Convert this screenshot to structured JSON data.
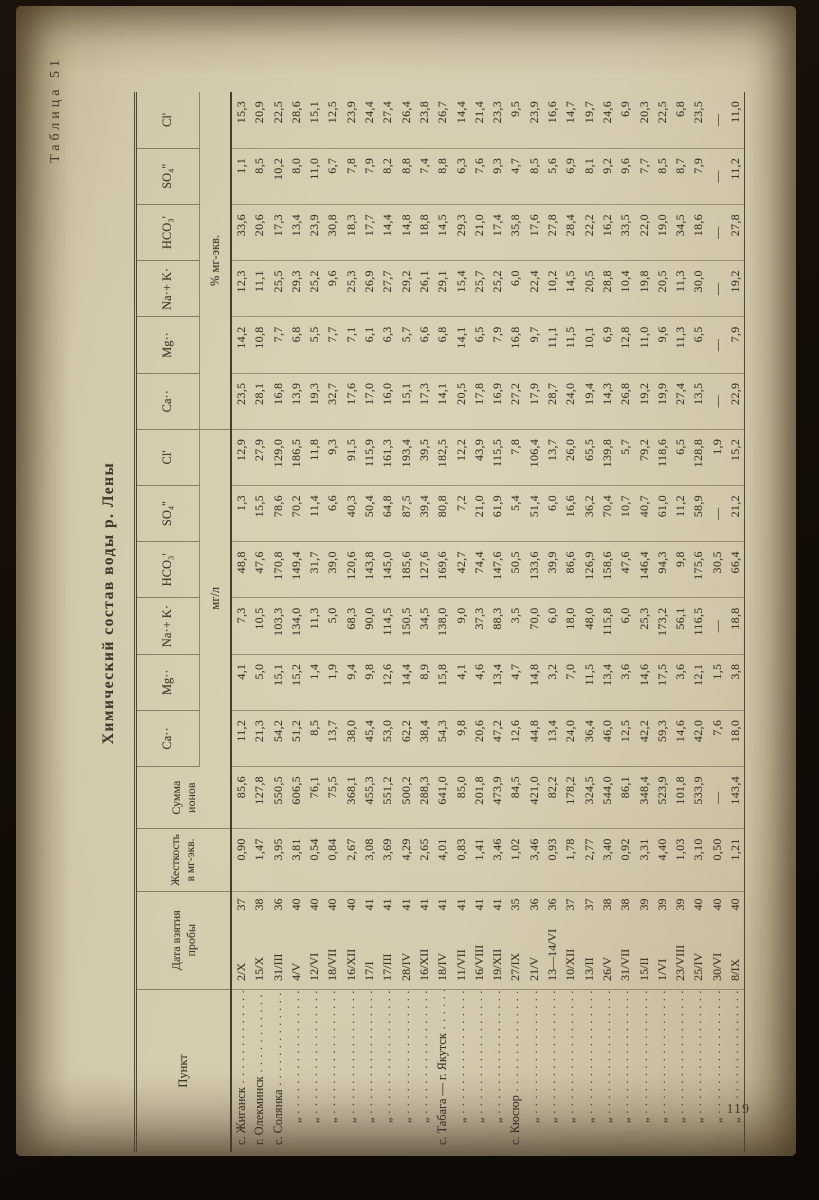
{
  "page": {
    "number": "119"
  },
  "titles": {
    "table_label": "Таблица 51",
    "main_title": "Химический состав воды р. Лены"
  },
  "table": {
    "headers": {
      "punkt": "Пункт",
      "date": "Дата взятия пробы",
      "hardness": "Жесткость в мг-экв.",
      "sum": "Сумма ионов",
      "group_mg": "мг/л",
      "group_pct": "% мг-экв."
    },
    "ions": [
      "Ca··",
      "Mg··",
      "Na·+ K·",
      "HCO₃'",
      "SO₄''",
      "Cl'"
    ],
    "leader_dots": ". . . . . . . . . . . . . . . . . . . . . . . .",
    "ditto_mark": "„",
    "rows": [
      {
        "punkt": "с. Жиганск",
        "ditto": false,
        "date": "2/X",
        "year": "37",
        "hardness": "0,90",
        "sum": "85,6",
        "mg": [
          "11,2",
          "4,1",
          "7,3",
          "48,8",
          "1,3",
          "12,9"
        ],
        "pct": [
          "23,5",
          "14,2",
          "12,3",
          "33,6",
          "1,1",
          "15,3"
        ]
      },
      {
        "punkt": "г. Олекминск",
        "ditto": false,
        "date": "15/X",
        "year": "38",
        "hardness": "1,47",
        "sum": "127,8",
        "mg": [
          "21,3",
          "5,0",
          "10,5",
          "47,6",
          "15,5",
          "27,9"
        ],
        "pct": [
          "28,1",
          "10,8",
          "11,1",
          "20,6",
          "8,5",
          "20,9"
        ]
      },
      {
        "punkt": "с. Солянка",
        "ditto": false,
        "date": "31/III",
        "year": "36",
        "hardness": "3,95",
        "sum": "550,5",
        "mg": [
          "54,2",
          "15,1",
          "103,3",
          "170,8",
          "78,6",
          "129,0"
        ],
        "pct": [
          "16,8",
          "7,7",
          "25,5",
          "17,3",
          "10,2",
          "22,5"
        ]
      },
      {
        "punkt": "„",
        "ditto": true,
        "date": "4/V",
        "year": "40",
        "hardness": "3,81",
        "sum": "606,5",
        "mg": [
          "51,2",
          "15,2",
          "134,0",
          "149,4",
          "70,2",
          "186,5"
        ],
        "pct": [
          "13,9",
          "6,8",
          "29,3",
          "13,4",
          "8,0",
          "28,6"
        ]
      },
      {
        "punkt": "„",
        "ditto": true,
        "date": "12/VI",
        "year": "40",
        "hardness": "0,54",
        "sum": "76,1",
        "mg": [
          "8,5",
          "1,4",
          "11,3",
          "31,7",
          "11,4",
          "11,8"
        ],
        "pct": [
          "19,3",
          "5,5",
          "25,2",
          "23,9",
          "11,0",
          "15,1"
        ]
      },
      {
        "punkt": "„",
        "ditto": true,
        "date": "18/VII",
        "year": "40",
        "hardness": "0,84",
        "sum": "75,5",
        "mg": [
          "13,7",
          "1,9",
          "5,0",
          "39,0",
          "6,6",
          "9,3"
        ],
        "pct": [
          "32,7",
          "7,7",
          "9,6",
          "30,8",
          "6,7",
          "12,5"
        ]
      },
      {
        "punkt": "„",
        "ditto": true,
        "date": "16/XII",
        "year": "40",
        "hardness": "2,67",
        "sum": "368,1",
        "mg": [
          "38,0",
          "9,4",
          "68,3",
          "120,6",
          "40,3",
          "91,5"
        ],
        "pct": [
          "17,6",
          "7,1",
          "25,3",
          "18,3",
          "7,8",
          "23,9"
        ]
      },
      {
        "punkt": "„",
        "ditto": true,
        "date": "17/I",
        "year": "41",
        "hardness": "3,08",
        "sum": "455,3",
        "mg": [
          "45,4",
          "9,8",
          "90,0",
          "143,8",
          "50,4",
          "115,9"
        ],
        "pct": [
          "17,0",
          "6,1",
          "26,9",
          "17,7",
          "7,9",
          "24,4"
        ]
      },
      {
        "punkt": "„",
        "ditto": true,
        "date": "17/III",
        "year": "41",
        "hardness": "3,69",
        "sum": "551,2",
        "mg": [
          "53,0",
          "12,6",
          "114,5",
          "145,0",
          "64,8",
          "161,3"
        ],
        "pct": [
          "16,0",
          "6,3",
          "27,7",
          "14,4",
          "8,2",
          "27,4"
        ]
      },
      {
        "punkt": "„",
        "ditto": true,
        "date": "28/IV",
        "year": "41",
        "hardness": "4,29",
        "sum": "500,2",
        "mg": [
          "62,2",
          "14,4",
          "150,5",
          "185,6",
          "87,5",
          "193,4"
        ],
        "pct": [
          "15,1",
          "5,7",
          "29,2",
          "14,8",
          "8,8",
          "26,4"
        ]
      },
      {
        "punkt": "„",
        "ditto": true,
        "date": "16/XII",
        "year": "41",
        "hardness": "2,65",
        "sum": "288,3",
        "mg": [
          "38,4",
          "8,9",
          "34,5",
          "127,6",
          "39,4",
          "39,5"
        ],
        "pct": [
          "17,3",
          "6,6",
          "26,1",
          "18,8",
          "7,4",
          "23,8"
        ]
      },
      {
        "punkt": "с. Табага — г. Якутск",
        "ditto": false,
        "date": "18/IV",
        "year": "41",
        "hardness": "4,01",
        "sum": "641,0",
        "mg": [
          "54,3",
          "15,8",
          "138,0",
          "169,6",
          "80,8",
          "182,5"
        ],
        "pct": [
          "14,1",
          "6,8",
          "29,1",
          "14,5",
          "8,8",
          "26,7"
        ]
      },
      {
        "punkt": "„",
        "ditto": true,
        "date": "11/VII",
        "year": "41",
        "hardness": "0,83",
        "sum": "85,0",
        "mg": [
          "9,8",
          "4,1",
          "9,0",
          "42,7",
          "7,2",
          "12,2"
        ],
        "pct": [
          "20,5",
          "14,1",
          "15,4",
          "29,3",
          "6,3",
          "14,4"
        ]
      },
      {
        "punkt": "„",
        "ditto": true,
        "date": "16/VIII",
        "year": "41",
        "hardness": "1,41",
        "sum": "201,8",
        "mg": [
          "20,6",
          "4,6",
          "37,3",
          "74,4",
          "21,0",
          "43,9"
        ],
        "pct": [
          "17,8",
          "6,5",
          "25,7",
          "21,0",
          "7,6",
          "21,4"
        ]
      },
      {
        "punkt": "„",
        "ditto": true,
        "date": "19/XII",
        "year": "41",
        "hardness": "3,46",
        "sum": "473,9",
        "mg": [
          "47,2",
          "13,4",
          "88,3",
          "147,6",
          "61,9",
          "115,5"
        ],
        "pct": [
          "16,9",
          "7,9",
          "25,2",
          "17,4",
          "9,3",
          "23,3"
        ]
      },
      {
        "punkt": "с. Кюсюр",
        "ditto": false,
        "date": "27/IX",
        "year": "35",
        "hardness": "1,02",
        "sum": "84,5",
        "mg": [
          "12,6",
          "4,7",
          "3,5",
          "50,5",
          "5,4",
          "7,8"
        ],
        "pct": [
          "27,2",
          "16,8",
          "6,0",
          "35,8",
          "4,7",
          "9,5"
        ]
      },
      {
        "punkt": "„",
        "ditto": true,
        "date": "21/V",
        "year": "36",
        "hardness": "3,46",
        "sum": "421,0",
        "mg": [
          "44,8",
          "14,8",
          "70,0",
          "133,6",
          "51,4",
          "106,4"
        ],
        "pct": [
          "17,9",
          "9,7",
          "22,4",
          "17,6",
          "8,5",
          "23,9"
        ]
      },
      {
        "punkt": "„",
        "ditto": true,
        "date": "13—14/VI",
        "year": "36",
        "hardness": "0,93",
        "sum": "82,2",
        "mg": [
          "13,4",
          "3,2",
          "6,0",
          "39,9",
          "6,0",
          "13,7"
        ],
        "pct": [
          "28,7",
          "11,1",
          "10,2",
          "27,8",
          "5,6",
          "16,6"
        ]
      },
      {
        "punkt": "„",
        "ditto": true,
        "date": "10/XII",
        "year": "37",
        "hardness": "1,78",
        "sum": "178,2",
        "mg": [
          "24,0",
          "7,0",
          "18,0",
          "86,6",
          "16,6",
          "26,0"
        ],
        "pct": [
          "24,0",
          "11,5",
          "14,5",
          "28,4",
          "6,9",
          "14,7"
        ]
      },
      {
        "punkt": "„",
        "ditto": true,
        "date": "13/II",
        "year": "37",
        "hardness": "2,77",
        "sum": "324,5",
        "mg": [
          "36,4",
          "11,5",
          "48,0",
          "126,9",
          "36,2",
          "65,5"
        ],
        "pct": [
          "19,4",
          "10,1",
          "20,5",
          "22,2",
          "8,1",
          "19,7"
        ]
      },
      {
        "punkt": "„",
        "ditto": true,
        "date": "26/V",
        "year": "38",
        "hardness": "3,40",
        "sum": "544,0",
        "mg": [
          "46,0",
          "13,4",
          "115,8",
          "158,6",
          "70,4",
          "139,8"
        ],
        "pct": [
          "14,3",
          "6,9",
          "28,8",
          "16,2",
          "9,2",
          "24,6"
        ]
      },
      {
        "punkt": "„",
        "ditto": true,
        "date": "31/VII",
        "year": "38",
        "hardness": "0,92",
        "sum": "86,1",
        "mg": [
          "12,5",
          "3,6",
          "6,0",
          "47,6",
          "10,7",
          "5,7"
        ],
        "pct": [
          "26,8",
          "12,8",
          "10,4",
          "33,5",
          "9,6",
          "6,9"
        ]
      },
      {
        "punkt": "„",
        "ditto": true,
        "date": "15/II",
        "year": "39",
        "hardness": "3,31",
        "sum": "348,4",
        "mg": [
          "42,2",
          "14,6",
          "25,3",
          "146,4",
          "40,7",
          "79,2"
        ],
        "pct": [
          "19,2",
          "11,0",
          "19,8",
          "22,0",
          "7,7",
          "20,3"
        ]
      },
      {
        "punkt": "„",
        "ditto": true,
        "date": "1/VI",
        "year": "39",
        "hardness": "4,40",
        "sum": "523,9",
        "mg": [
          "59,3",
          "17,5",
          "173,2",
          "94,3",
          "61,0",
          "118,6"
        ],
        "pct": [
          "19,9",
          "9,6",
          "20,5",
          "19,0",
          "8,5",
          "22,5"
        ]
      },
      {
        "punkt": "„",
        "ditto": true,
        "date": "23/VIII",
        "year": "39",
        "hardness": "1,03",
        "sum": "101,8",
        "mg": [
          "14,6",
          "3,6",
          "56,1",
          "9,8",
          "11,2",
          "6,5"
        ],
        "pct": [
          "27,4",
          "11,3",
          "11,3",
          "34,5",
          "8,7",
          "6,8"
        ]
      },
      {
        "punkt": "„",
        "ditto": true,
        "date": "25/IV",
        "year": "40",
        "hardness": "3,10",
        "sum": "533,9",
        "mg": [
          "42,0",
          "12,1",
          "116,5",
          "175,6",
          "58,9",
          "128,8"
        ],
        "pct": [
          "13,5",
          "6,5",
          "30,0",
          "18,6",
          "7,9",
          "23,5"
        ]
      },
      {
        "punkt": "„",
        "ditto": true,
        "date": "30/VI",
        "year": "40",
        "hardness": "0,50",
        "sum": "—",
        "mg": [
          "7,6",
          "1,5",
          "—",
          "30,5",
          "—",
          "1,9"
        ],
        "pct": [
          "—",
          "—",
          "—",
          "—",
          "—",
          "—"
        ]
      },
      {
        "punkt": "„",
        "ditto": true,
        "date": "8/IX",
        "year": "40",
        "hardness": "1,21",
        "sum": "143,4",
        "mg": [
          "18,0",
          "3,8",
          "18,8",
          "66,4",
          "21,2",
          "15,2"
        ],
        "pct": [
          "22,9",
          "7,9",
          "19,2",
          "27,8",
          "11,2",
          "11,0"
        ]
      }
    ]
  }
}
